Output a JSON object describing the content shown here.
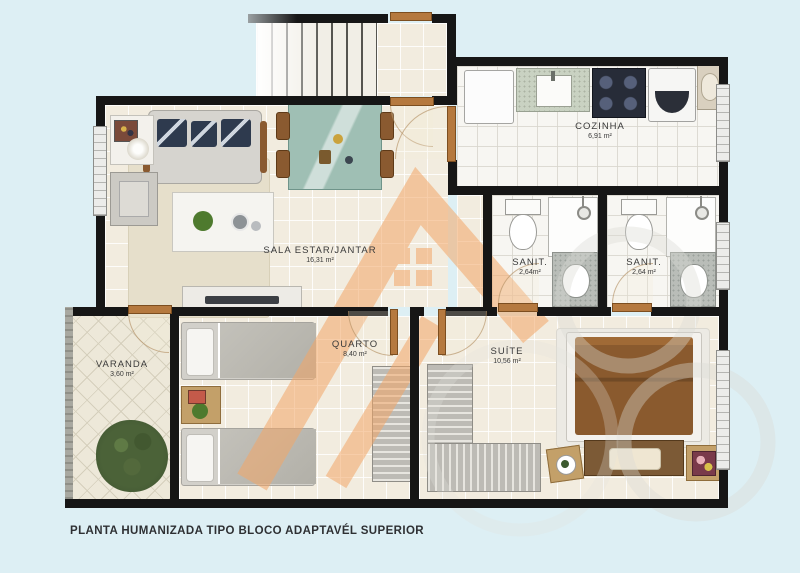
{
  "title_caption": "PLANTA HUMANIZADA TIPO BLOCO ADAPTAVÉL SUPERIOR",
  "rooms": {
    "sala": {
      "name": "SALA ESTAR/JANTAR",
      "area": "16,31 m²"
    },
    "cozinha": {
      "name": "COZINHA",
      "area": "6,91 m²"
    },
    "sanit_1": {
      "name": "SANIT.",
      "area": "2,64m²"
    },
    "sanit_2": {
      "name": "SANIT.",
      "area": "2,64 m²"
    },
    "quarto": {
      "name": "QUARTO",
      "area": "8,40 m²"
    },
    "suite": {
      "name": "SUÍTE",
      "area": "10,56 m²"
    },
    "varanda": {
      "name": "VARANDA",
      "area": "3,60 m²"
    }
  },
  "colors": {
    "background": "#ddeff4",
    "floor_tile": "#f2ecdf",
    "wet_area_tile": "#f7f6f2",
    "wall": "#161616",
    "door_wood": "#b5793f",
    "watermark_orange": "#f3a768",
    "watermark_gray": "#d9d9d3"
  }
}
